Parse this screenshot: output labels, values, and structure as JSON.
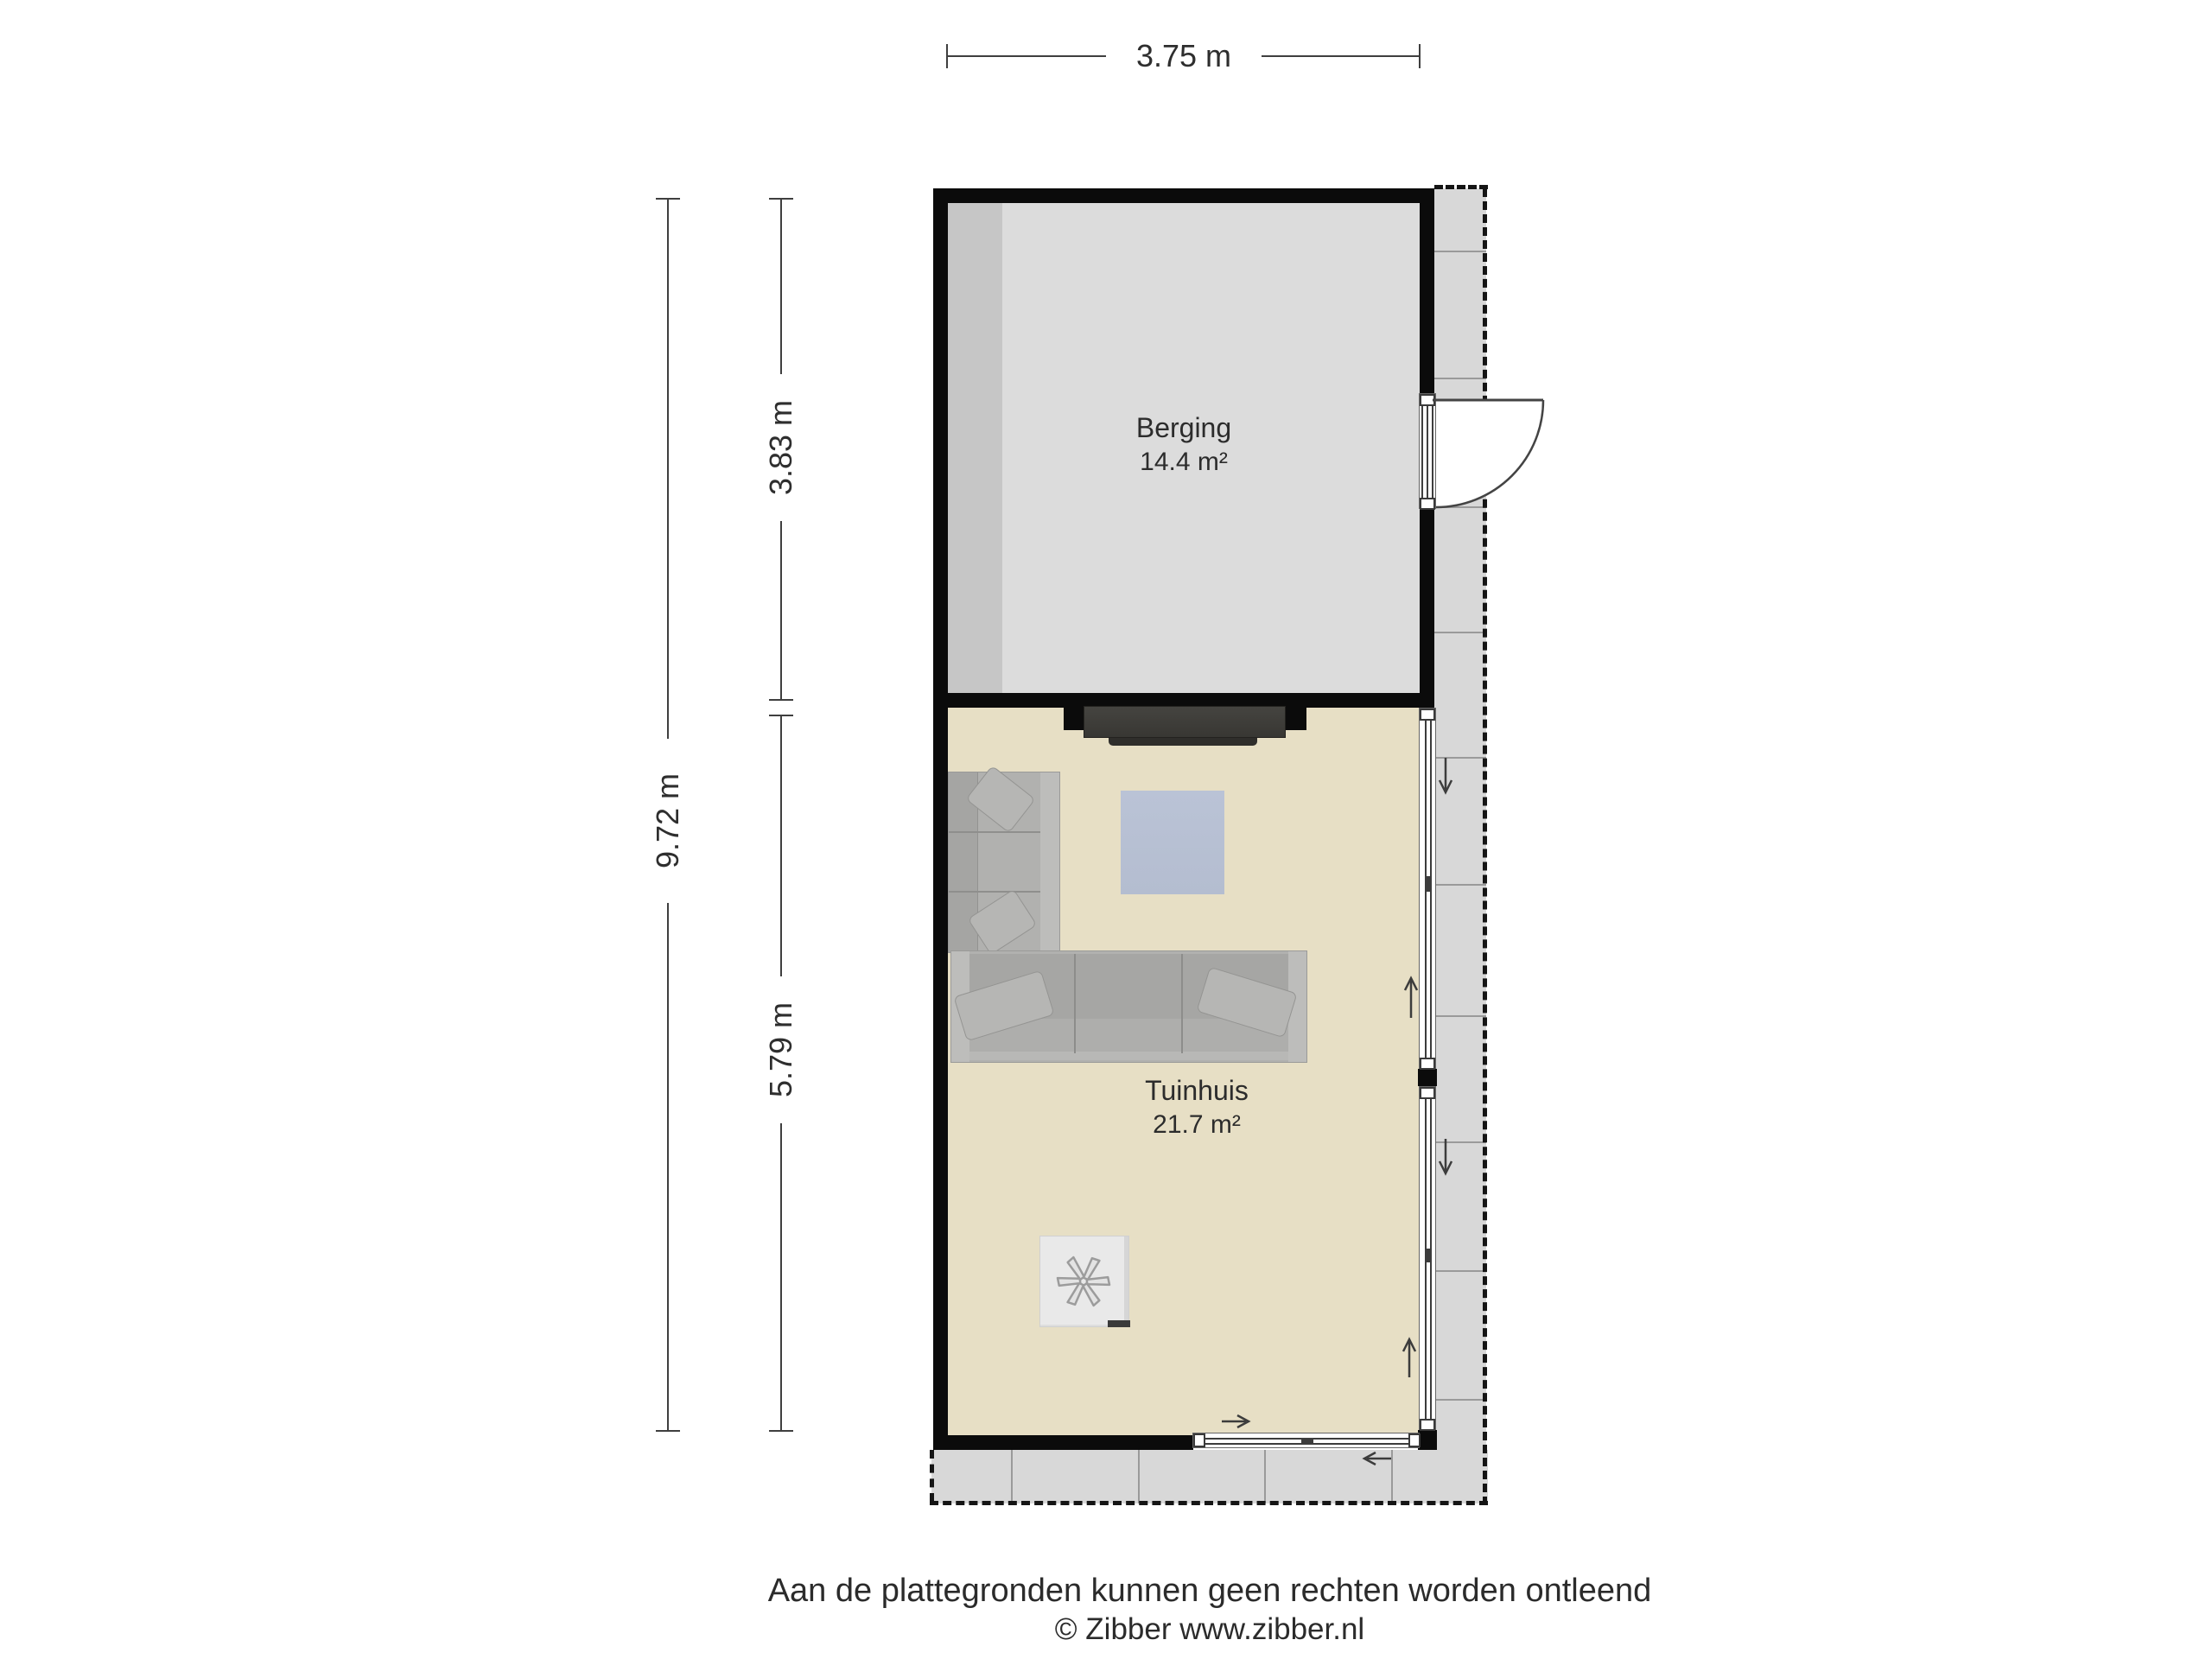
{
  "dimensions": {
    "width_top": "3.75 m",
    "height_total": "9.72 m",
    "height_berging": "3.83 m",
    "height_tuinhuis": "5.79 m"
  },
  "rooms": {
    "berging": {
      "name": "Berging",
      "area": "14.4 m²"
    },
    "tuinhuis": {
      "name": "Tuinhuis",
      "area": "21.7 m²"
    }
  },
  "footer": {
    "disclaimer": "Aan de plattegronden kunnen geen rechten worden ontleend",
    "copyright": "© Zibber www.zibber.nl"
  },
  "icons": {
    "stove_fan": "stove-fan-icon",
    "door_swing": "door-swing-arc",
    "slide_arrows": "slide-direction-arrows"
  },
  "colors": {
    "wall": "#0b0b0b",
    "berging_floor": "#dcdcdc",
    "berging_floor_shadow": "#c6c6c6",
    "tuinhuis_floor": "#e7dfc5",
    "terrace": "#d8d8d8",
    "terrace_joint": "#9a9a9a",
    "rug": "#b4bdd0",
    "sofa": "#b1b1af",
    "tv_cabinet": "#3c3b38",
    "stove": "#e9e9e9",
    "dimension_line": "#3f3f3f",
    "text": "#2b2b2b"
  }
}
